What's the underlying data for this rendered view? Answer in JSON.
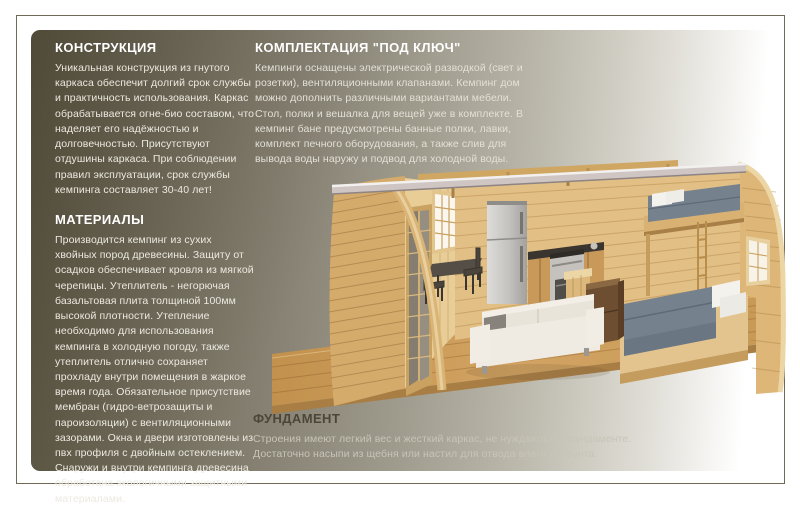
{
  "page": {
    "background": "#ffffff",
    "frame_border_color": "#6e6a5a",
    "card_gradient": [
      "#5d5745",
      "#868172",
      "#bdbaae",
      "#ffffff"
    ]
  },
  "sections": {
    "construction": {
      "heading": "КОНСТРУКЦИЯ",
      "body": "Уникальная конструкция из гнутого каркаса обеспечит долгий срок службы и практичность использования. Каркас обрабатывается огне-био составом, что наделяет его надёжностью и долговечностью. Присутствуют отдушины каркаса. При соблюдении правил эксплуатации, срок службы кемпинга составляет 30-40 лет!"
    },
    "materials": {
      "heading": "МАТЕРИАЛЫ",
      "body": "Производится кемпинг из сухих хвойных пород древесины. Защиту от осадков обеспечивает кровля из мягкой черепицы. Утеплитель - негорючая базальтовая плита толщиной 100мм высокой плотности. Утепление необходимо для использования кемпинга в холодную погоду, также утеплитель отлично сохраняет прохладу внутри помещения в жаркое время года. Обязательное присутствие мембран (гидро-ветрозащиты и пароизоляции) с вентиляционными зазорами. Окна и двери изготовлены из пвх профиля с двойным остеклением. Снаружи и внутри кемпинга древесина обработана экологичными защитными материалами."
    },
    "turnkey": {
      "heading": "КОМПЛЕКТАЦИЯ \"ПОД КЛЮЧ\"",
      "body": "Кемпинги оснащены электрической разводкой (свет и розетки), вентиляционными клапанами. Кемпинг дом можно дополнить различными вариантами мебели. Стол, полки и вешалка для вещей уже в комплекте. В кемпинг бане предусмотрены банные полки, лавки, комплект печного оборудования, а также слив для вывода воды наружу и подвод для холодной воды."
    },
    "foundation": {
      "heading": "ФУНДАМЕНТ",
      "body": "Строения имеют легкий вес и жесткий каркас, не нуждаются в фундаменте. Достаточно насыпи из щебня или настил для отвода влаги от грунта."
    }
  },
  "illustration": {
    "name": "cabin-cutaway-render",
    "colors": {
      "wood_light": "#e2bf85",
      "wood_mid": "#d5ab6c",
      "wood_dark": "#b98e4d",
      "floor": "#cfa05d",
      "roof_band": "#cfc6c4",
      "mattress": "#76818e",
      "pillow": "#f4f2ed",
      "sofa": "#efebe2",
      "appliance_silver": "#c9c7c4",
      "counter_top": "#3a362f",
      "window_glow": "#fbf7ee",
      "dark_furniture": "#6d4e30"
    }
  }
}
